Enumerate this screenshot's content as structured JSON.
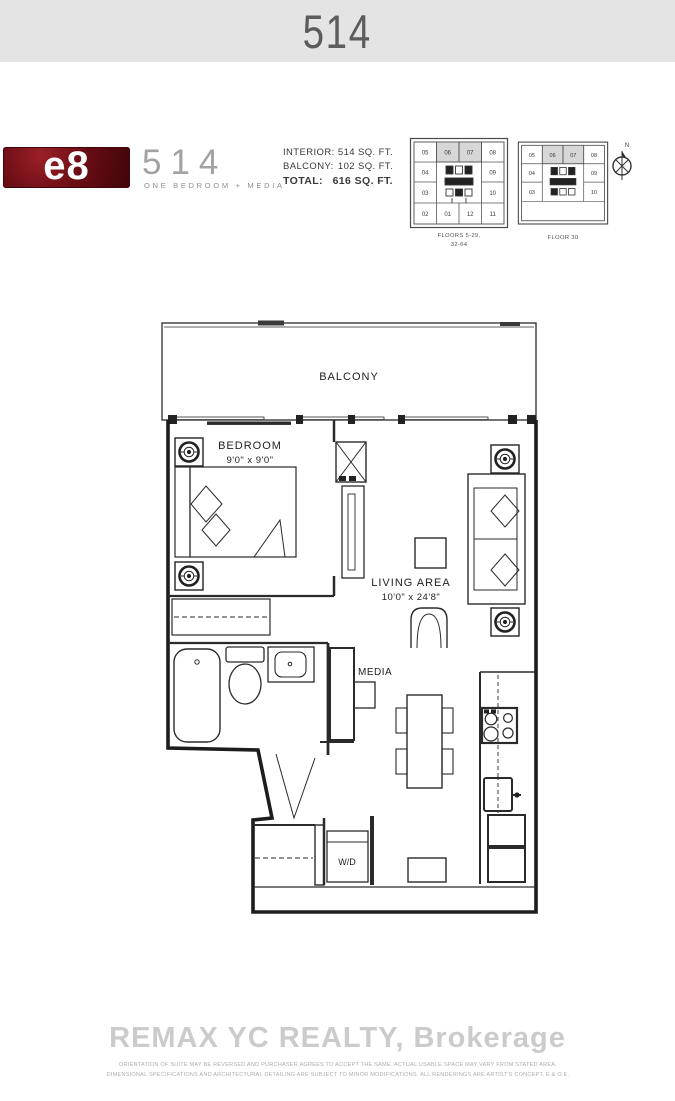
{
  "header": {
    "unit_number": "514"
  },
  "logo": {
    "brand": "e8",
    "model": "514",
    "subtitle": "ONE BEDROOM + MEDIA"
  },
  "areas": {
    "interior": {
      "label": "INTERIOR:",
      "value": "514 SQ. FT."
    },
    "balcony": {
      "label": "BALCONY:",
      "value": "102 SQ. FT."
    },
    "total": {
      "label": "TOTAL:",
      "value": "616 SQ. FT."
    }
  },
  "keyplans": {
    "plan_a": {
      "row1": [
        "05",
        "06",
        "07",
        "08"
      ],
      "row2_left": "04",
      "row2_right": "09",
      "row3_left": "03",
      "row3_right": "10",
      "row4": [
        "02",
        "01",
        "12",
        "11"
      ],
      "caption1": "FLOORS 5-29,",
      "caption2": "32-64",
      "highlighted_units": "06, 07"
    },
    "plan_b": {
      "row1": [
        "05",
        "06",
        "07",
        "08"
      ],
      "row2_left": "04",
      "row2_right": "09",
      "row3_left": "03",
      "row3_right": "10",
      "caption": "FLOOR 30",
      "highlighted_units": "06, 07"
    },
    "compass_n": "N"
  },
  "floorplan": {
    "balcony": "BALCONY",
    "bedroom_name": "BEDROOM",
    "bedroom_dims": "9'0\" x 9'0\"",
    "living_name": "LIVING AREA",
    "living_dims": "10'0\" x 24'8\"",
    "media": "MEDIA",
    "wd": "W/D"
  },
  "footer": {
    "watermark": "REMAX YC REALTY, Brokerage",
    "disclaimer1": "ORIENTATION OF SUITE MAY BE REVERSED AND PURCHASER AGREES TO ACCEPT THE SAME. ACTUAL USABLE SPACE MAY VARY FROM STATED AREA.",
    "disclaimer2": "DIMENSIONAL SPECIFICATIONS AND ARCHITECTURAL DETAILING ARE SUBJECT TO MINOR MODIFICATIONS. ALL RENDERINGS ARE ARTIST'S CONCEPT. E.& O.E."
  },
  "colors": {
    "header_bg": "#e4e4e5",
    "brand_red": "#6b0d14",
    "line": "#222222",
    "keyplan_highlight": "#d7d7d7",
    "watermark_gray": "#cbcbcb"
  }
}
